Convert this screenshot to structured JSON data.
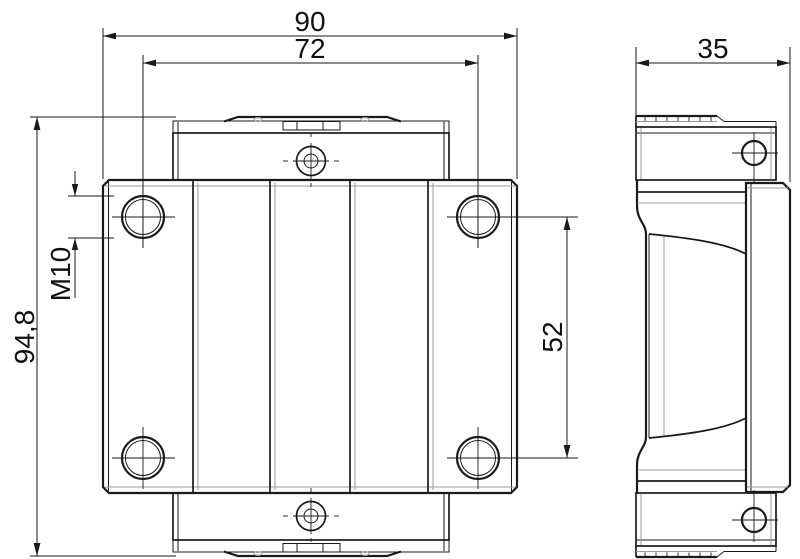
{
  "drawing": {
    "background_color": "#ffffff",
    "line_color": "#1a1a1a",
    "light_line_color": "#9a9a9a",
    "dimensions": {
      "overall_width": {
        "value": "90"
      },
      "hole_spacing_horizontal": {
        "value": "72"
      },
      "side_width": {
        "value": "35"
      },
      "overall_length": {
        "value": "94,8"
      },
      "mounting_thread": {
        "value": "M10"
      },
      "hole_spacing_vertical": {
        "value": "52"
      }
    }
  }
}
